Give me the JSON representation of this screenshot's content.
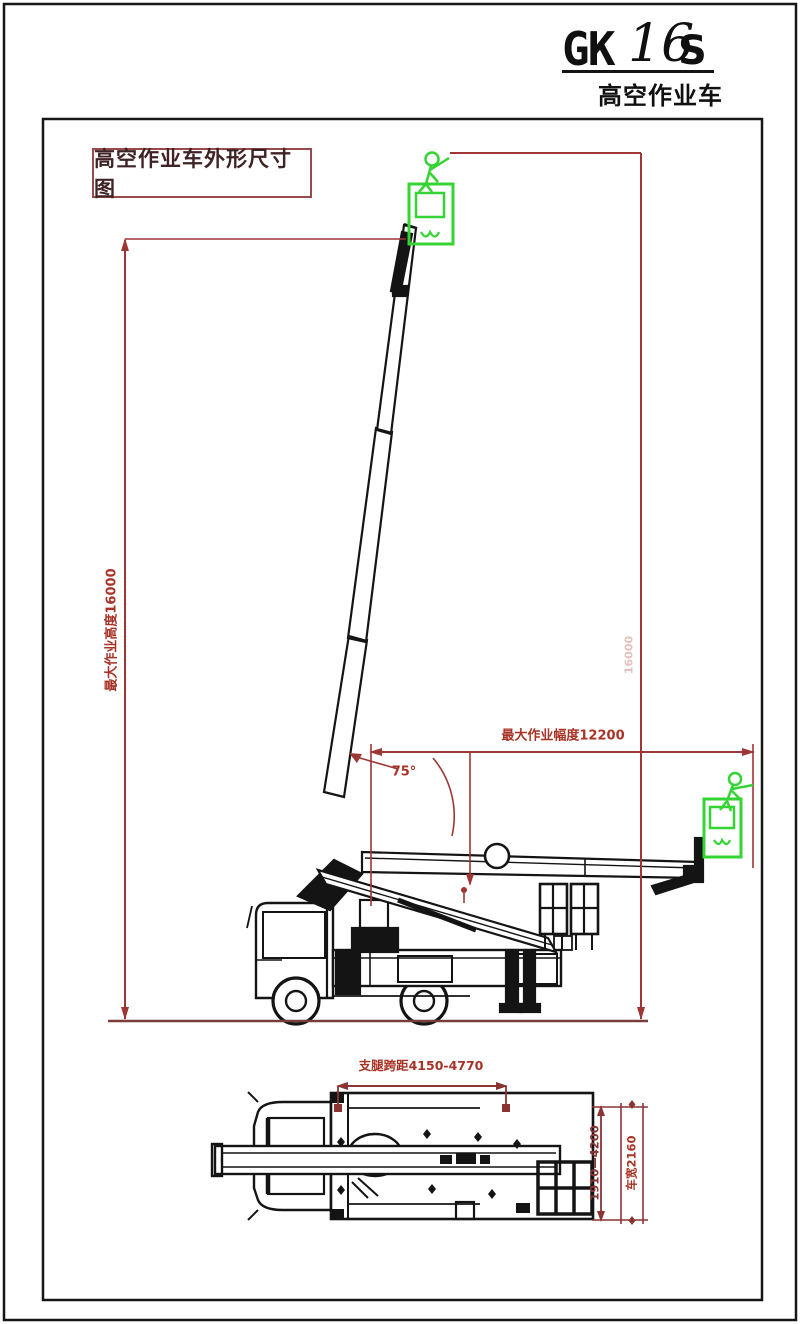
{
  "logo": {
    "brand": "GK",
    "model": "16",
    "series": "S",
    "subtitle": "高空作业车"
  },
  "drawing_title": "高空作业车外形尺寸图",
  "side_view": {
    "max_height_label": "最大作业高度16000",
    "height_faint_label": "16000",
    "max_radius_label": "最大作业幅度12200",
    "boom_angle_label": "75°"
  },
  "top_view": {
    "outrigger_span_label": "支腿跨距4150-4770",
    "outrigger_width_label": "1910—4200",
    "vehicle_width_label": "车宽2160"
  },
  "colors": {
    "dimension_red": "#a83226",
    "dimension_dark_red": "#8a3434",
    "ground_red": "#7a3b3b",
    "line_black": "#141414",
    "basket_green": "#35d435"
  }
}
